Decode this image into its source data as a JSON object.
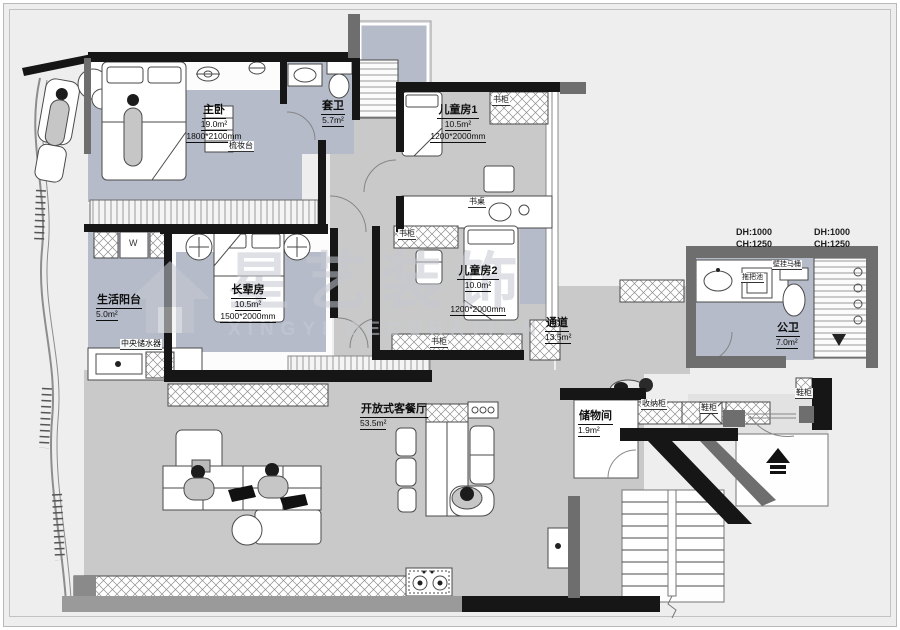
{
  "watermark": {
    "brand": "星艺装饰",
    "sub": "XINGYI DECORATION"
  },
  "rooms": [
    {
      "id": "master-bedroom",
      "name": "主卧",
      "area": "19.0m²",
      "dim": "1800*2100mm"
    },
    {
      "id": "ensuite-bath",
      "name": "套卫",
      "area": "5.7m²"
    },
    {
      "id": "kids-room-1",
      "name": "儿童房1",
      "area": "10.5m²",
      "dim": "1200*2000mm"
    },
    {
      "id": "kids-room-2",
      "name": "儿童房2",
      "area": "10.0m²",
      "dim": "1200*2000mm"
    },
    {
      "id": "elders-room",
      "name": "长辈房",
      "area": "10.5m²",
      "dim": "1500*2000mm"
    },
    {
      "id": "living-balcony",
      "name": "生活阳台",
      "area": "5.0m²"
    },
    {
      "id": "corridor",
      "name": "通道",
      "area": "13.5m²"
    },
    {
      "id": "public-bath",
      "name": "公卫",
      "area": "7.0m²"
    },
    {
      "id": "open-living-dining",
      "name": "开放式客餐厅",
      "area": "53.5m²"
    },
    {
      "id": "storage-room",
      "name": "储物间",
      "area": "1.9m²"
    }
  ],
  "fixtures": {
    "dressing_table": "梳妆台",
    "bookcase_kids1": "书柜",
    "bookcase_kids2_top": "书柜",
    "bookcase_kids2_bottom": "书柜",
    "desk": "书桌",
    "washer": "W",
    "central_water_heater": "中央储水器",
    "storage_cabinet": "收纳柜",
    "shoe_cabinet_left": "鞋柜",
    "shoe_cabinet_right": "鞋柜",
    "mop_sink": "拖把池",
    "wall_hung_toilet": "壁挂马桶"
  },
  "annotations": {
    "niche_left": {
      "dh": "DH:1000",
      "ch": "CH:1250"
    },
    "niche_right": {
      "dh": "DH:1000",
      "ch": "CH:1250"
    }
  },
  "colors": {
    "sheet_bg": "#eeeeee",
    "floor_gray": "#c9c9c9",
    "rug_blue": "#b5bbc9",
    "wall_black": "#161616",
    "wall_gray": "#6e6e6e"
  }
}
